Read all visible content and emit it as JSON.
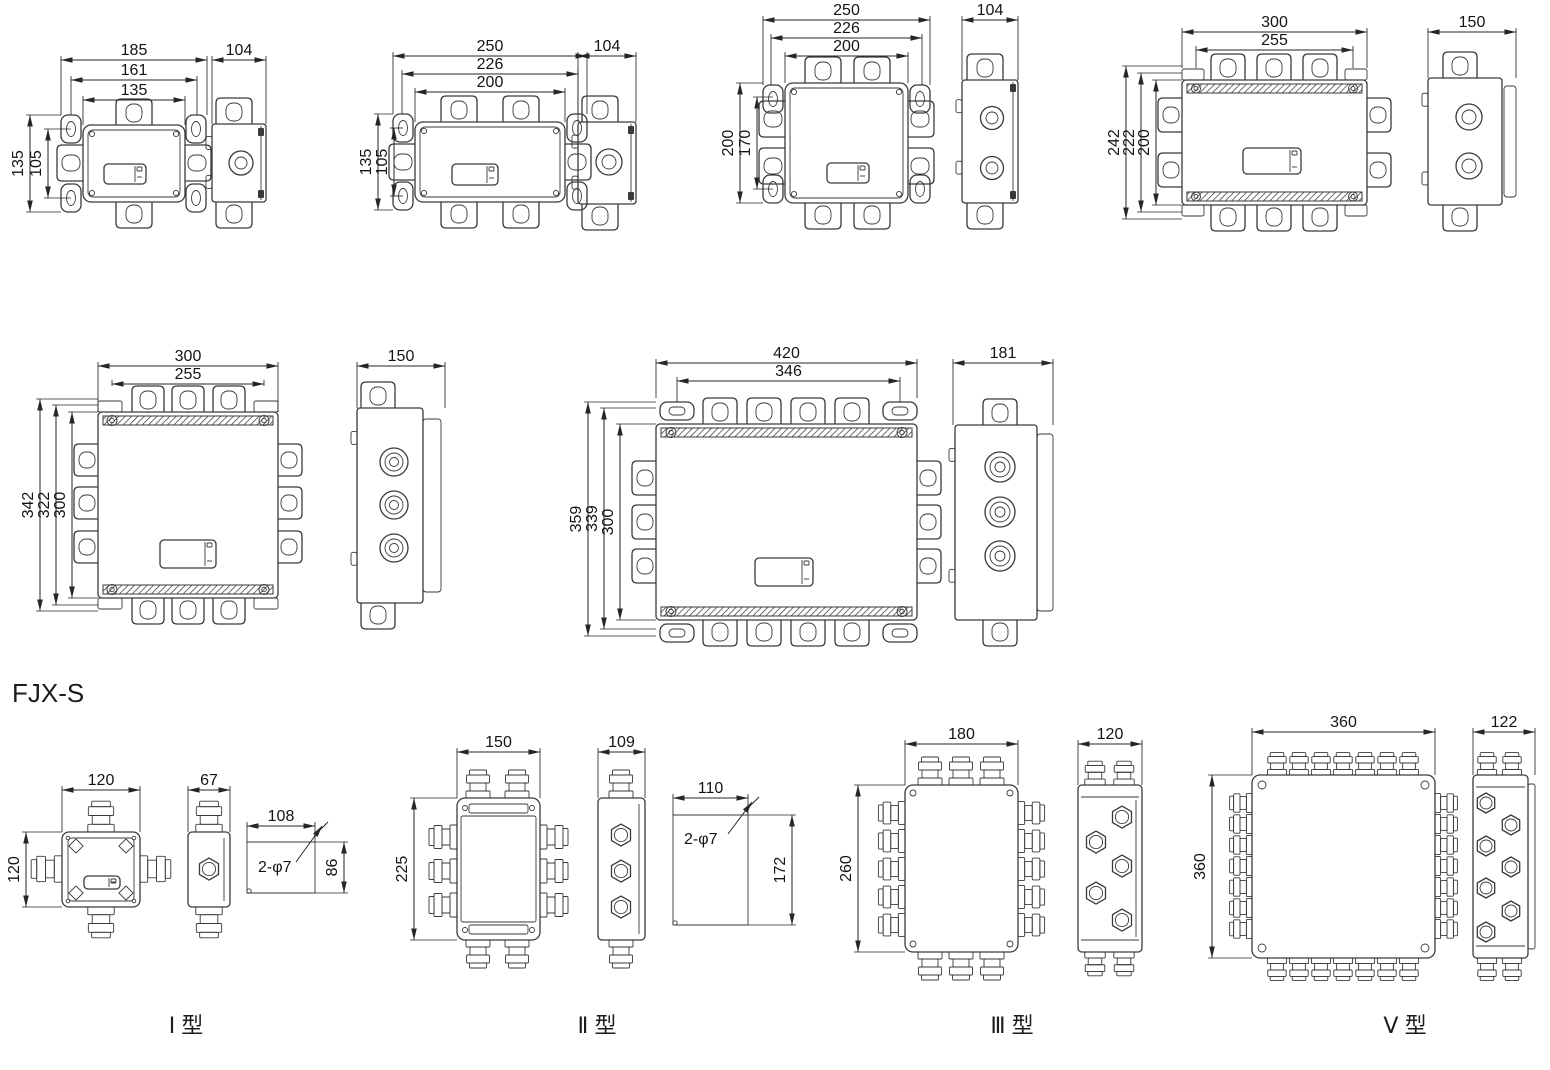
{
  "section_title": "FJX-S",
  "colors": {
    "line": "#3a3a3a",
    "text": "#141414",
    "background": "#ffffff"
  },
  "figures": {
    "box1": {
      "dims_top": [
        "185",
        "161",
        "135"
      ],
      "dims_left": [
        "135",
        "105"
      ],
      "side_width": "104"
    },
    "box2": {
      "dims_top": [
        "250",
        "226",
        "200"
      ],
      "dims_left": [
        "135",
        "105"
      ],
      "side_width": "104"
    },
    "box3": {
      "dims_top": [
        "250",
        "226",
        "200"
      ],
      "dims_left": [
        "200",
        "170"
      ],
      "side_width": "104"
    },
    "box4": {
      "dims_top": [
        "300",
        "255"
      ],
      "dims_left": [
        "242",
        "222",
        "200"
      ],
      "side_width": "150"
    },
    "box5": {
      "dims_top": [
        "300",
        "255"
      ],
      "dims_left": [
        "342",
        "322",
        "300"
      ],
      "side_width": "150"
    },
    "box6": {
      "dims_top": [
        "420",
        "346"
      ],
      "dims_left": [
        "359",
        "339",
        "300"
      ],
      "side_width": "181"
    },
    "type1": {
      "label": "Ⅰ 型",
      "width": "120",
      "height": "120",
      "side_width": "67",
      "plate_width": "108",
      "plate_height": "86",
      "holes": "2-φ7"
    },
    "type2": {
      "label": "Ⅱ 型",
      "width": "150",
      "height": "225",
      "side_width": "109",
      "plate_width": "110",
      "plate_height": "172",
      "holes": "2-φ7"
    },
    "type3": {
      "label": "Ⅲ 型",
      "width": "180",
      "height": "260",
      "side_width": "120"
    },
    "type5": {
      "label": "Ⅴ 型",
      "width": "360",
      "height": "360",
      "side_width": "122"
    }
  }
}
